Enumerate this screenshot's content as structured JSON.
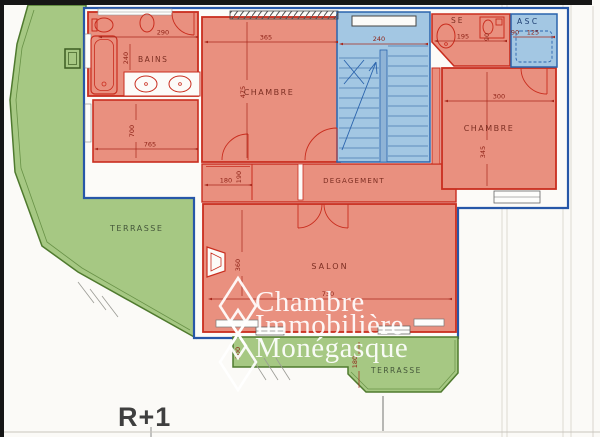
{
  "document": {
    "floor_label": "R+1",
    "watermark": {
      "line1": "Chambre",
      "line2": "Immobilière",
      "line3": "Monégasque"
    },
    "rooms": {
      "bains": "BAINS",
      "chambre_left": "CHAMBRE",
      "chambre_right": "CHAMBRE",
      "degagement": "DEGAGEMENT",
      "salon": "SALON",
      "se": "SE",
      "asc": "ASC",
      "terrasse_left": "TERRASSE",
      "terrasse_bottom": "TERRASSE"
    },
    "dimensions_cm": {
      "bains_width": "290",
      "bains_depth": "240",
      "chambre_left_width": "365",
      "chambre_left_depth": "475",
      "stairs_width": "240",
      "se_width": "195",
      "se_depth": "90",
      "asc_entry": "90",
      "asc_width": "125",
      "chambre_right_width": "300",
      "chambre_right_depth": "345",
      "left_wing_depth": "700",
      "left_wing_width": "765",
      "closet_width": "180",
      "closet_depth": "190",
      "salon_depth": "360",
      "salon_width": "730",
      "terrasse_strip_depth": "100",
      "terrasse_bottom_depth": "180"
    },
    "colors": {
      "room_fill": "#e9907f",
      "room_line": "#c92d1e",
      "terrace_fill": "#a6c883",
      "terrace_line": "#4f7a2e",
      "stair_fill": "#a3c7e3",
      "outer_wall": "#2757a8",
      "dimension": "#a8281c",
      "page_border": "#161616"
    }
  }
}
